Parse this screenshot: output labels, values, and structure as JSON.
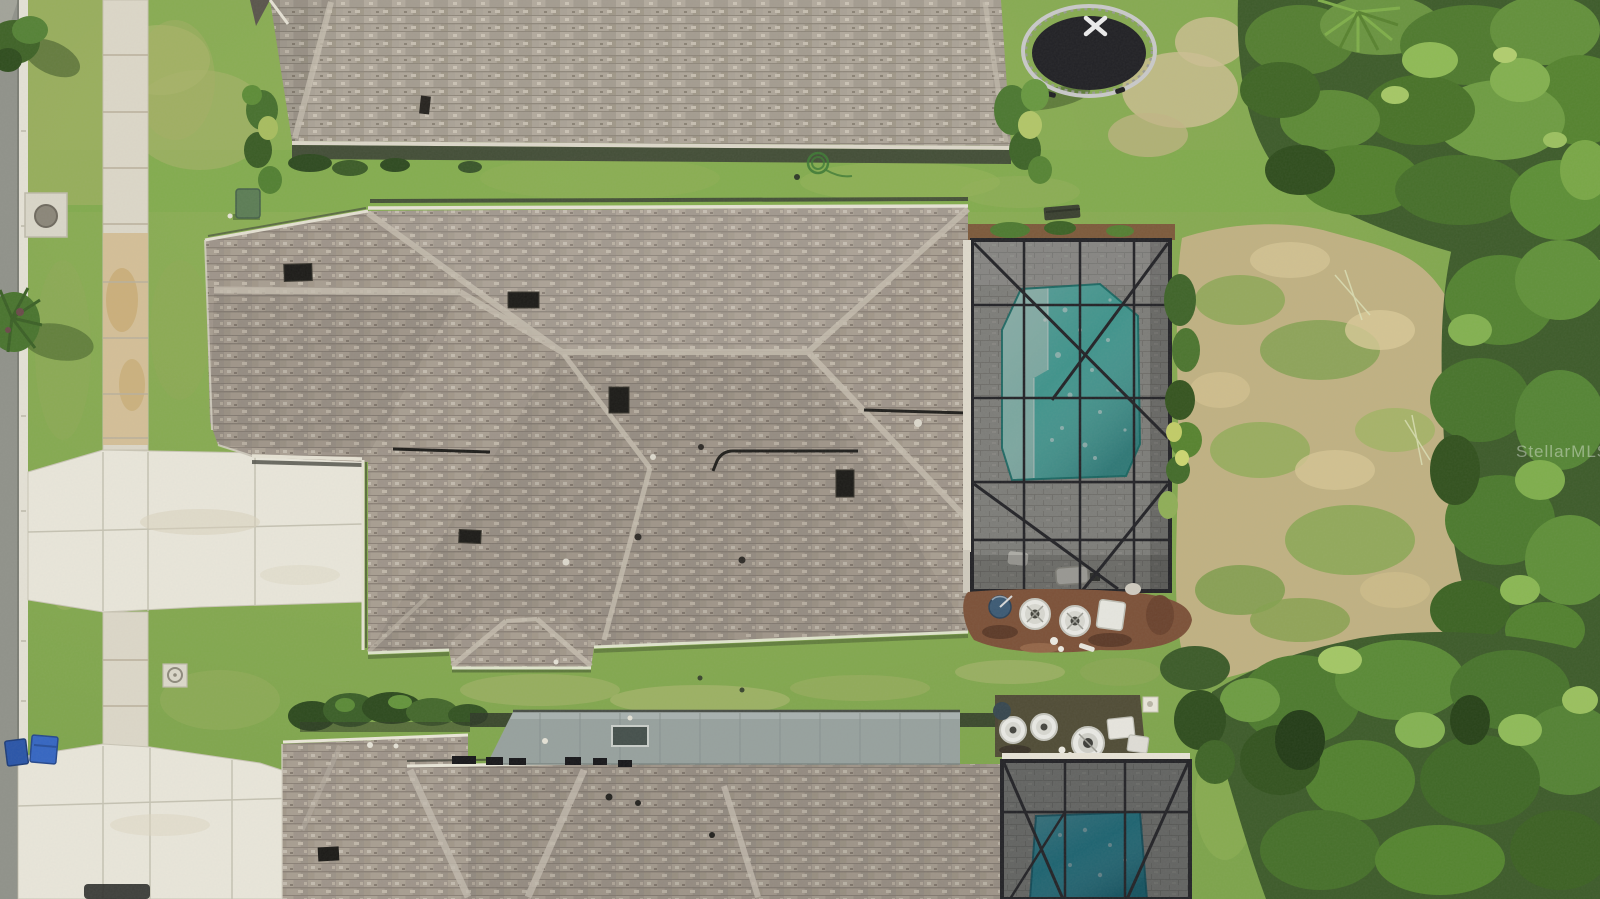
{
  "watermark": {
    "text": "StellarMLS"
  },
  "scene": {
    "description": "aerial-top-down-view-of-residential-property",
    "elements": [
      "street",
      "curb",
      "sidewalk",
      "driveway-upper",
      "driveway-lower",
      "top-house-roof",
      "main-house-roof",
      "lower-house-roof",
      "metal-lanai-roof",
      "screened-pool-enclosure-main",
      "screened-pool-enclosure-lower",
      "swimming-pool-main",
      "swimming-pool-lower",
      "sun-shelf",
      "trampoline",
      "trampoline-x-mark",
      "trees",
      "dry-scrub",
      "lawn",
      "ac-condenser-units",
      "pool-equipment",
      "satellite-dish",
      "recycle-bins",
      "manhole-cover",
      "utility-pad",
      "utility-box",
      "garden-hose",
      "roof-vents",
      "skylight",
      "mulch-beds"
    ]
  },
  "colors": {
    "lawn": "#7da44b",
    "road": "#90928a",
    "concrete": "#e9e6da",
    "sidewalk_tan": "#d3bd92",
    "roof_shingle": "#a49a8e",
    "metal_roof": "#97a19e",
    "pool_water": "#4fbfb4",
    "pool_shelf": "#a7dcd2",
    "pool_water_lower": "#2a9fb4",
    "enclosure_frame": "#232327",
    "paver_deck": "#a3a19c",
    "mulch": "#7c5138",
    "scrub": "#c3b184",
    "trees_dark": "#3d5b2a",
    "trees_light": "#6a9440",
    "trampoline_mat": "#212125",
    "trampoline_frame": "#c9c9c9",
    "recycle_bin": "#2a55a8",
    "recycle_bin2": "#3566c2",
    "watermark": "#ffffff"
  }
}
